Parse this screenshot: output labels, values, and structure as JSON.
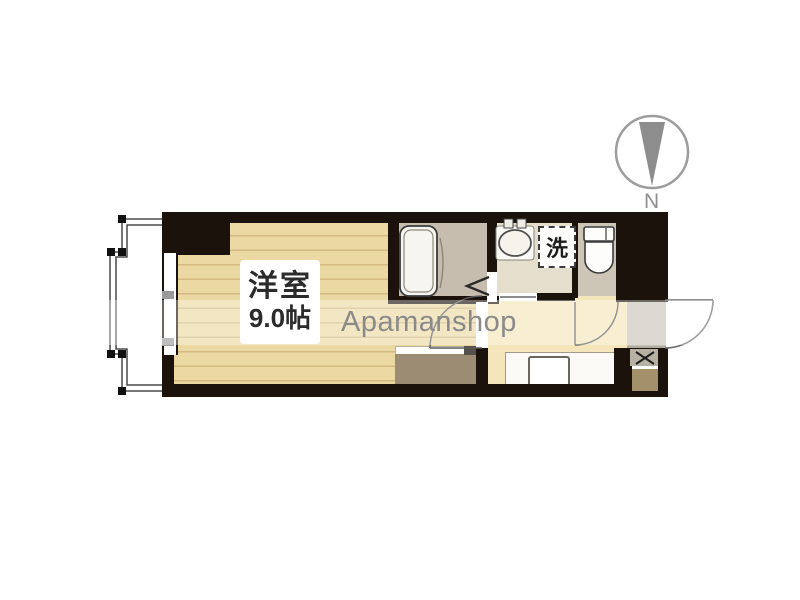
{
  "watermark": {
    "text": "Apamanshop"
  },
  "compass": {
    "label": "N"
  },
  "rooms": {
    "main_room": {
      "name": "洋室",
      "size": "9.0帖"
    },
    "washer_space": {
      "symbol": "洗"
    }
  },
  "colors": {
    "wall": "#1a120b",
    "wood_floor": "#ecd8a2",
    "bath_floor": "#c7bdae",
    "washroom_floor": "#e6decd",
    "toilet_floor": "#cdc5b6",
    "corridor_floor": "#f4e6ba",
    "entrance_floor": "#c8c3b9",
    "closet": "#9c8c73",
    "watermark_text": "#8a8a8a",
    "compass": "#8d8d8d"
  }
}
